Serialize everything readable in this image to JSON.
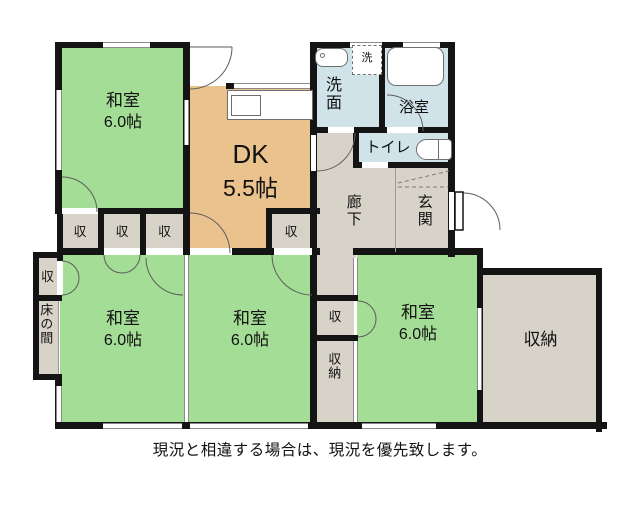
{
  "caption": "現況と相違する場合は、現況を優先致します。",
  "colors": {
    "tatami_green": "#a3dd96",
    "dk_tan": "#eac28d",
    "wet_area_blue": "#cfe3e8",
    "hall_gray": "#d7d3c8",
    "wall_black": "#141414"
  },
  "rooms": {
    "washitsu_tl": {
      "name": "和室",
      "size": "6.0帖"
    },
    "dk": {
      "name": "DK",
      "size": "5.5帖"
    },
    "senmen": {
      "name": "洗面"
    },
    "laundry": {
      "name": "洗"
    },
    "bath": {
      "name": "浴室"
    },
    "toilet": {
      "name": "トイレ"
    },
    "hallway": {
      "name": "廊下"
    },
    "entrance": {
      "name": "玄関"
    },
    "closet_1": {
      "name": "収"
    },
    "closet_2": {
      "name": "収"
    },
    "closet_3": {
      "name": "収"
    },
    "closet_4": {
      "name": "収"
    },
    "closet_left": {
      "name": "収"
    },
    "tokonoma": {
      "name": "床の間"
    },
    "washitsu_bl": {
      "name": "和室",
      "size": "6.0帖"
    },
    "washitsu_bc": {
      "name": "和室",
      "size": "6.0帖"
    },
    "washitsu_br": {
      "name": "和室",
      "size": "6.0帖"
    },
    "closet_center": {
      "name": "収"
    },
    "storage_center": {
      "name": "収納"
    },
    "storage_large": {
      "name": "収納"
    }
  }
}
